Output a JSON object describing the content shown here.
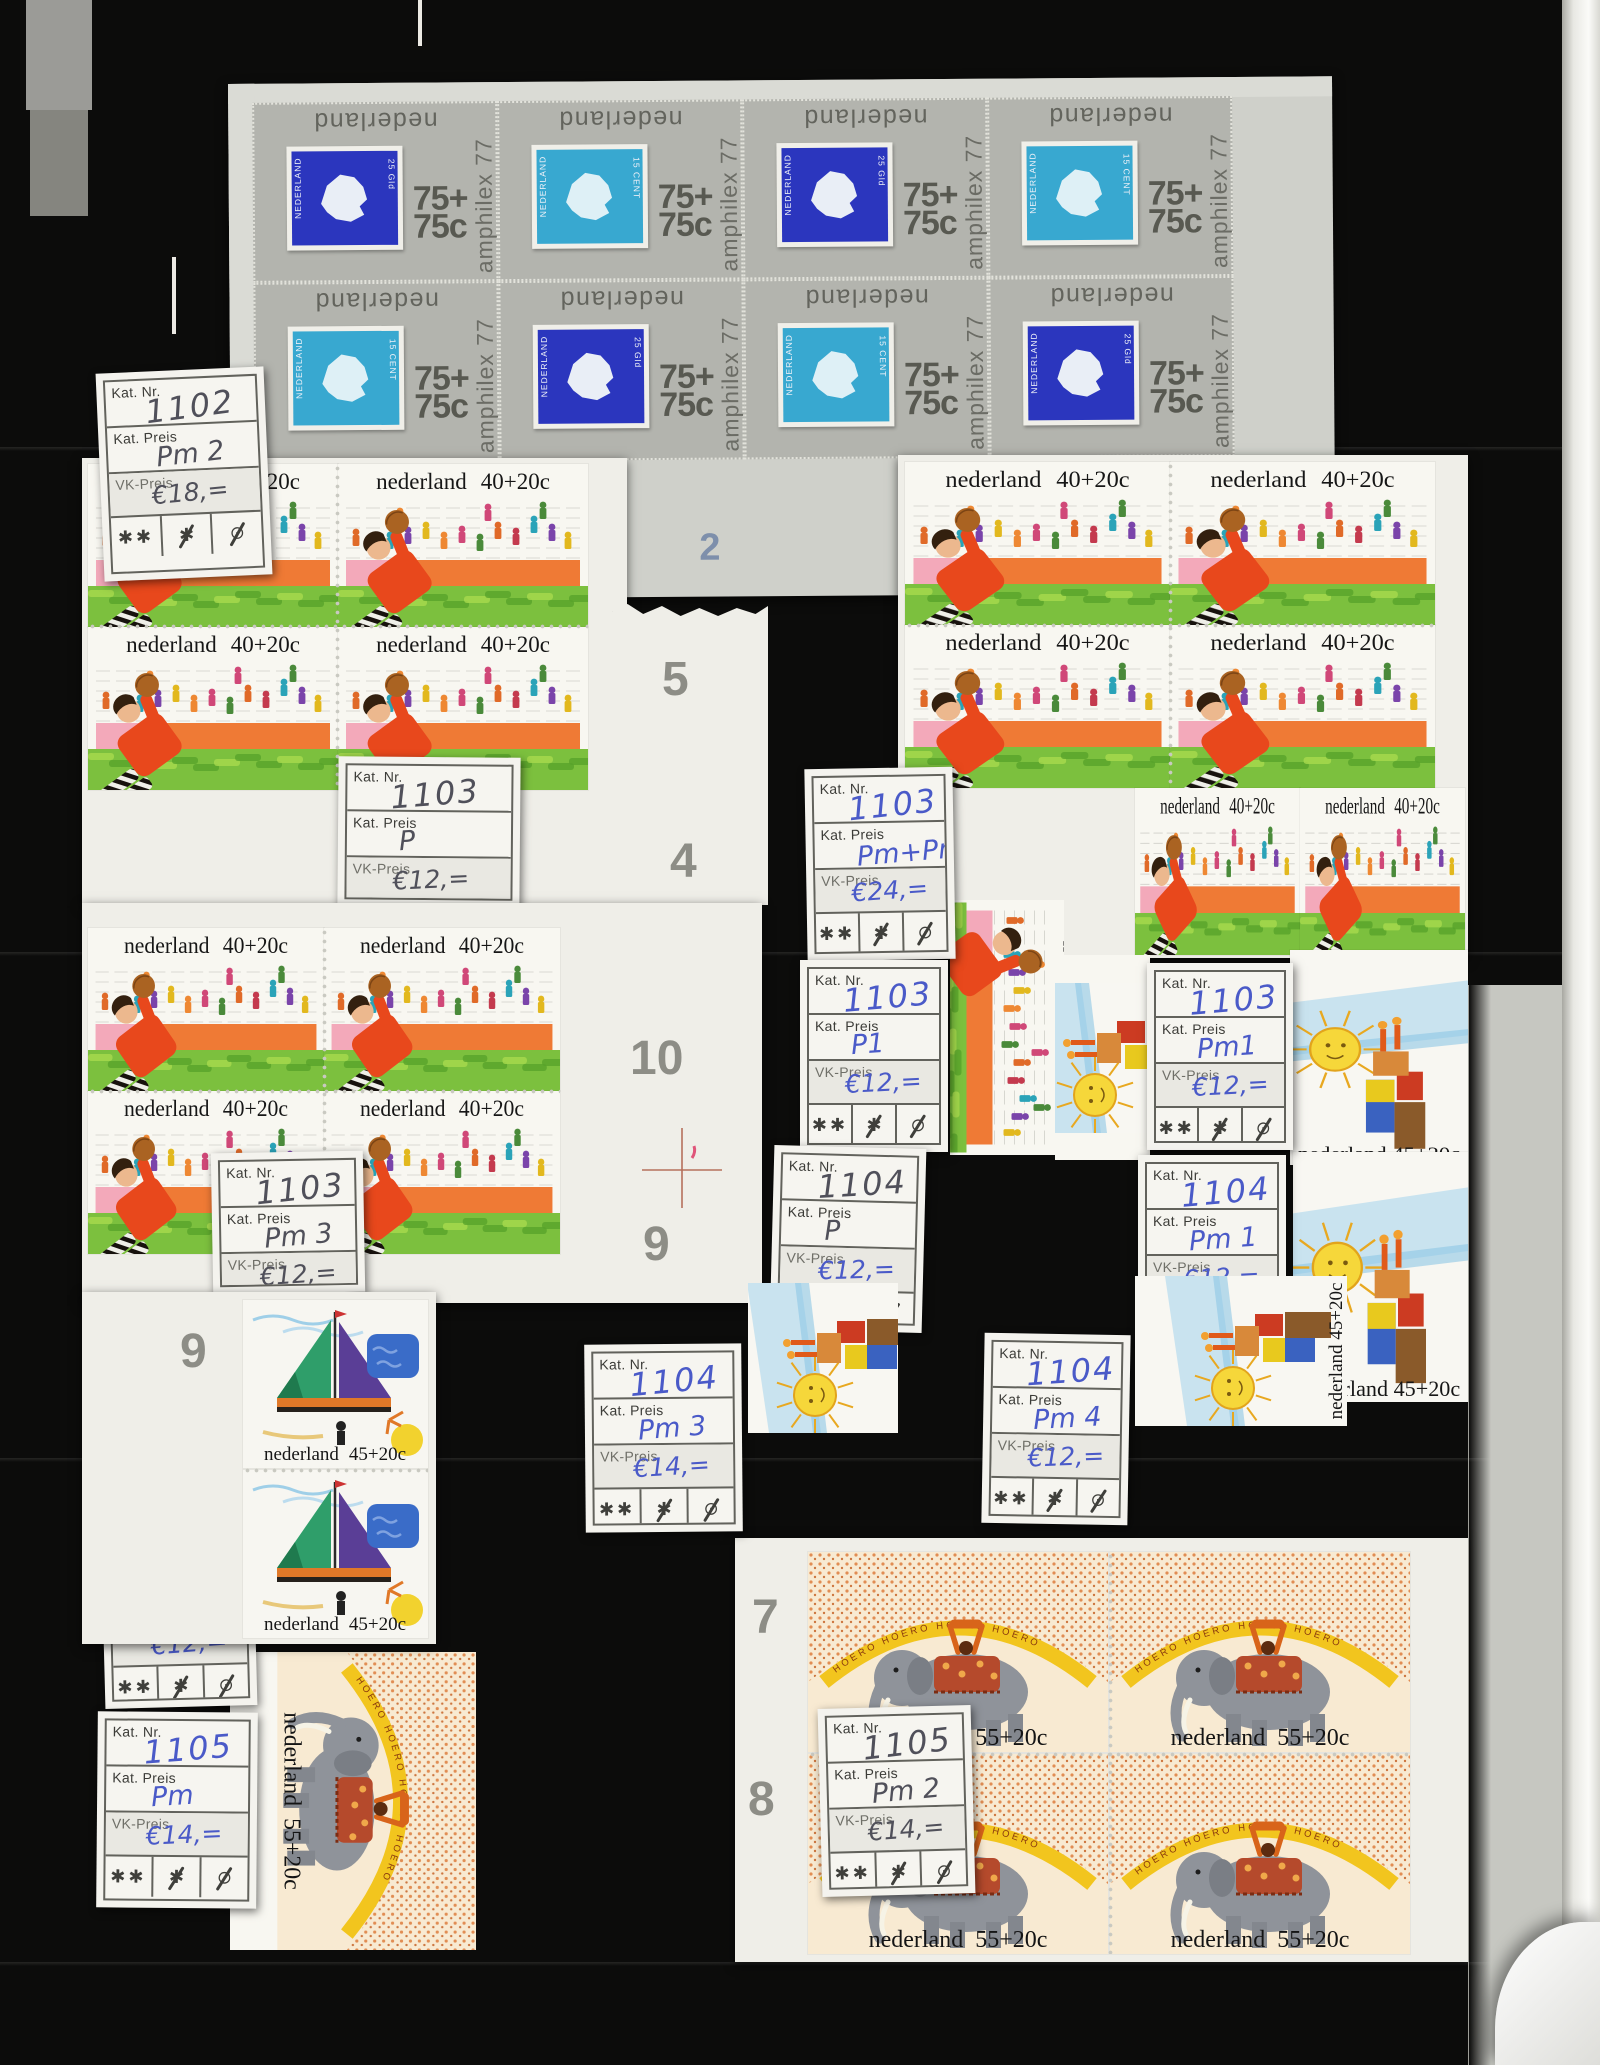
{
  "texts": {
    "nederland": "nederland",
    "value_40": "40+20c",
    "value_45": "45+20c",
    "value_55": "55+20c",
    "amphilex": "amphilex 77",
    "value_75_top": "75+",
    "value_75_bottom": "75c",
    "inner_country": "NEDERLAND",
    "inner_25": "25 Gld",
    "inner_15": "15 CENT",
    "hoero_band": "HOERO HOERO HOERO HOERO"
  },
  "label_captions": {
    "kat_nr": "Kat. Nr.",
    "kat_preis": "Kat. Preis",
    "vk_preis": "VK-Preis"
  },
  "symbols": {
    "mint_never_hinged": "✱✱",
    "hinged": "✱",
    "used": "⊙"
  },
  "labels": [
    {
      "kat_nr": "1102",
      "kat_preis": "Pm 2",
      "vk_preis": "€18,=",
      "ink": "pencil"
    },
    {
      "kat_nr": "1103",
      "kat_preis": "P",
      "vk_preis": "€12,=",
      "ink": "pencil"
    },
    {
      "kat_nr": "1103",
      "kat_preis": "Pm+Pm2",
      "vk_preis": "€24,=",
      "ink": "blue"
    },
    {
      "kat_nr": "1103",
      "kat_preis": "P1",
      "vk_preis": "€12,=",
      "ink": "blue"
    },
    {
      "kat_nr": "1103",
      "kat_preis": "Pm1",
      "vk_preis": "€12,=",
      "ink": "blue"
    },
    {
      "kat_nr": "1104",
      "kat_preis": "Pm 1",
      "vk_preis": "€12,=",
      "ink": "blue"
    },
    {
      "kat_nr": "1103",
      "kat_preis": "Pm 3",
      "vk_preis": "€12,=",
      "ink": "pencil"
    },
    {
      "kat_nr": "1104",
      "kat_preis": "P",
      "vk_preis": "€12,=",
      "ink": "mixed"
    },
    {
      "kat_nr": "1104",
      "kat_preis": "Pm 3",
      "vk_preis": "€14,=",
      "ink": "blue"
    },
    {
      "kat_nr": "1104",
      "kat_preis": "Pm 4",
      "vk_preis": "€12,=",
      "ink": "blue"
    },
    {
      "kat_nr": "1104",
      "kat_preis": "Pm 2",
      "vk_preis": "€12,=",
      "ink": "blue"
    },
    {
      "kat_nr": "1105",
      "kat_preis": "Pm",
      "vk_preis": "€14,=",
      "ink": "blue"
    },
    {
      "kat_nr": "1105",
      "kat_preis": "Pm 2",
      "vk_preis": "€14,=",
      "ink": "pencil"
    }
  ],
  "margin_numbers": [
    {
      "text": "1"
    },
    {
      "text": "2"
    },
    {
      "text": "3"
    },
    {
      "text": "4"
    },
    {
      "text": "5"
    },
    {
      "text": "4"
    },
    {
      "text": "10"
    },
    {
      "text": "9"
    },
    {
      "text": "9"
    },
    {
      "text": "7"
    },
    {
      "text": "8"
    }
  ],
  "colors": {
    "label_ink_blue": "#4a5ac8",
    "label_ink_pencil": "#50505a",
    "amphilex_stamp_gray": "#b3b4ae",
    "inner_stamp_blue": "#2b36be",
    "inner_stamp_teal": "#38a8d0",
    "margin_number_blue": "#7e8fab",
    "margin_number_gray": "#8d8d86",
    "background": "#0c0c0b"
  }
}
